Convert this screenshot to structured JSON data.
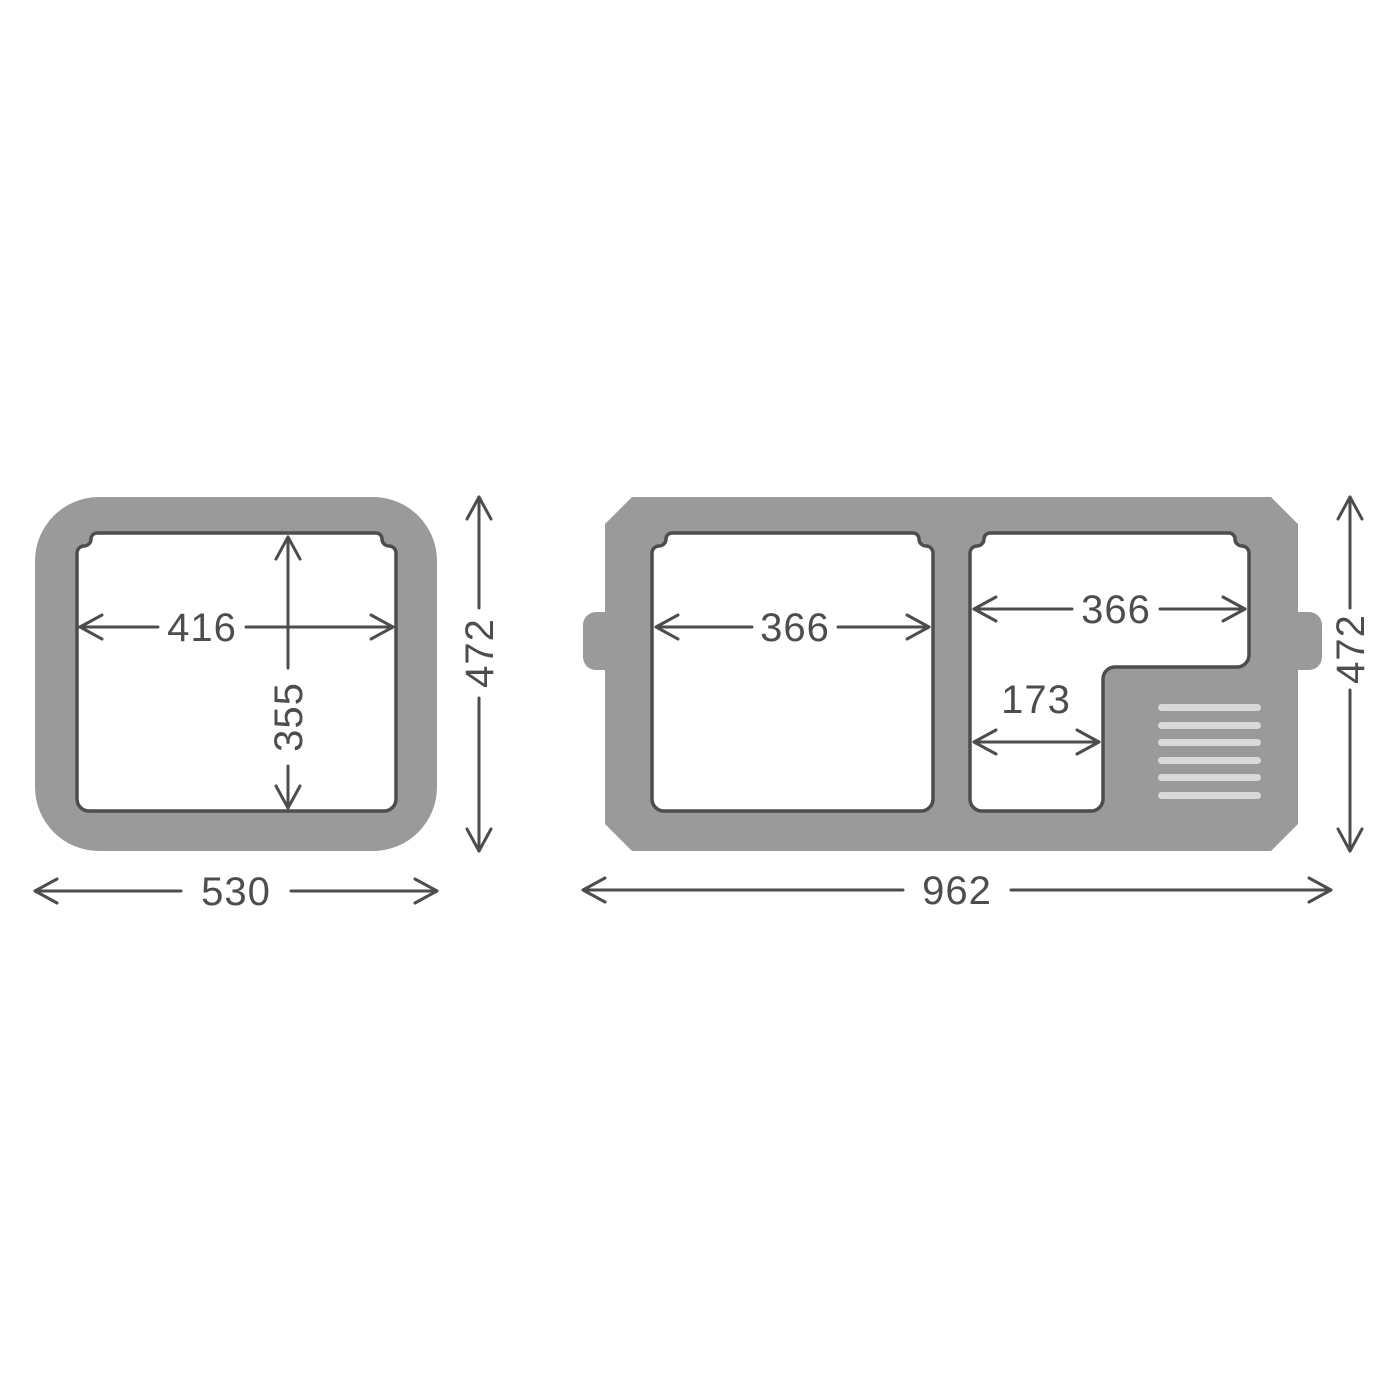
{
  "diagram": {
    "kind": "product-dimension-drawing",
    "views": {
      "left": "single-zone-top-view",
      "right": "dual-zone-top-view"
    }
  },
  "left_view": {
    "dimensions": {
      "inner_width": "416",
      "inner_depth": "355",
      "outer_depth": "472",
      "outer_width": "530"
    }
  },
  "right_view": {
    "dimensions": {
      "left_compartment_width": "366",
      "right_compartment_width": "366",
      "right_compartment_lower_width": "173",
      "outer_depth": "472",
      "outer_width": "962"
    },
    "vent_line_count": 6
  },
  "colors": {
    "body_gray": "#9a9a9a",
    "line_dark": "#4d4d4d",
    "vent_light": "#d9d9d9",
    "compartment_white": "#ffffff",
    "background": "#ffffff"
  }
}
